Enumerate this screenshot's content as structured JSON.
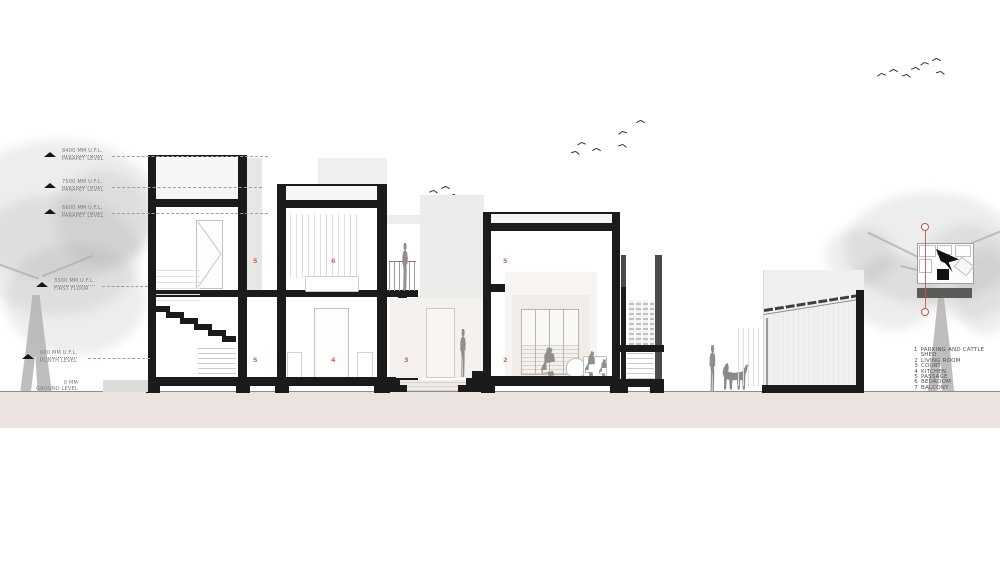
{
  "drawing": {
    "levels": [
      {
        "elevation": "8400 MM U.F.L.",
        "name": "PARAPET LEVEL"
      },
      {
        "elevation": "7500 MM U.F.L.",
        "name": "PARAPET LEVEL"
      },
      {
        "elevation": "6600 MM U.F.L.",
        "name": "PARAPET LEVEL"
      },
      {
        "elevation": "3300 MM U.F.L.",
        "name": "FIRST FLOOR"
      },
      {
        "elevation": "600 MM U.F.L.",
        "name": "PLINTH LEVEL"
      },
      {
        "elevation": "0 MM",
        "name": "GROUND LEVEL"
      }
    ],
    "legend": [
      {
        "num": "1",
        "label": "PARKING AND CATTLE SHED"
      },
      {
        "num": "2",
        "label": "LIVING ROOM"
      },
      {
        "num": "3",
        "label": "COURT"
      },
      {
        "num": "4",
        "label": "KITCHEN"
      },
      {
        "num": "5",
        "label": "PASSAGE"
      },
      {
        "num": "6",
        "label": "BEDROOM"
      },
      {
        "num": "7",
        "label": "BALCONY"
      }
    ],
    "room_markers": [
      {
        "num": "5"
      },
      {
        "num": "6"
      },
      {
        "num": "7"
      },
      {
        "num": "5"
      },
      {
        "num": "4"
      },
      {
        "num": "3"
      },
      {
        "num": "5"
      },
      {
        "num": "2"
      }
    ],
    "colors": {
      "wall_cut": "#1b1b1b",
      "ground_fill": "#eae3df",
      "marker_red": "#c96a5f",
      "column_grey": "#4a4a4a"
    }
  }
}
